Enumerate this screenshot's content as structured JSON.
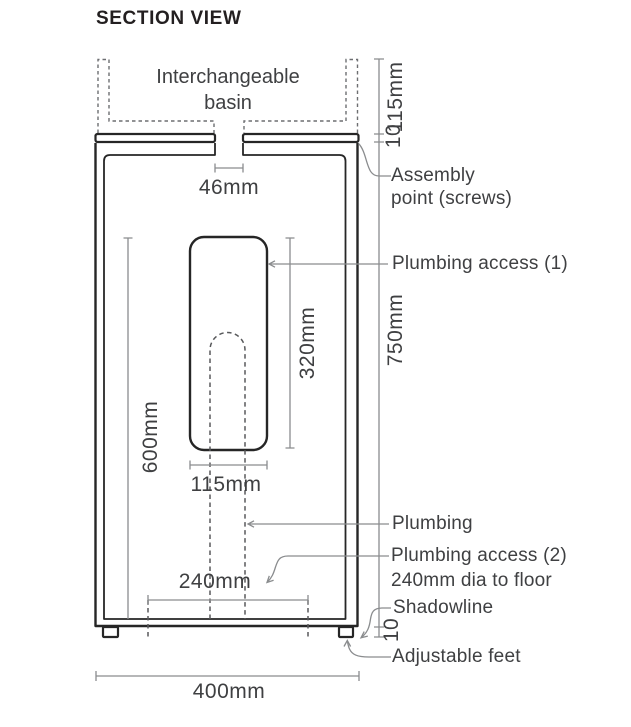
{
  "title": "SECTION VIEW",
  "labels": {
    "basin_line1": "Interchangeable",
    "basin_line2": "basin",
    "assembly_line1": "Assembly",
    "assembly_line2": "point (screws)",
    "plumbing_access_1": "Plumbing access (1)",
    "plumbing": "Plumbing",
    "plumbing_access_2_line1": "Plumbing access (2)",
    "plumbing_access_2_line2": "240mm dia to floor",
    "shadowline": "Shadowline",
    "adjustable_feet": "Adjustable feet"
  },
  "dimensions": {
    "basin_gap": "46mm",
    "basin_height": "115mm",
    "counter_thickness": "10",
    "cabinet_height": "750mm",
    "access_opening_height": "320mm",
    "interior_height": "600mm",
    "access_opening_width": "115mm",
    "floor_access_dia": "240mm",
    "feet_height": "10",
    "cabinet_width": "400mm"
  },
  "colors": {
    "outline": "#262626",
    "dimension": "#8a8c8e",
    "dashed": "#6d6e71",
    "text": "#3f4042",
    "background": "#ffffff"
  }
}
